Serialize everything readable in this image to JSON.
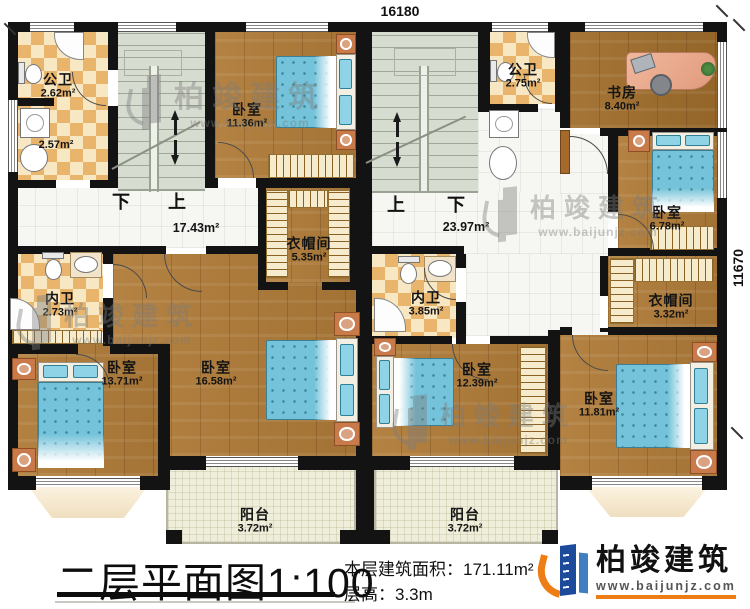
{
  "dimensions": {
    "top": "16180",
    "right": "11670"
  },
  "stairs": {
    "left_down": "下",
    "left_up": "上",
    "right_up": "上",
    "right_down": "下"
  },
  "rooms": {
    "bath_tl": {
      "name": "公卫",
      "area": "2.62m²",
      "area2": "2.57m²"
    },
    "bedroom_tl": {
      "name": "卧室",
      "area": "11.36m²"
    },
    "cloak_left": {
      "name": "衣帽间",
      "area": "5.35m²"
    },
    "hall_left": {
      "area": "17.43m²"
    },
    "bath_ml": {
      "name": "内卫",
      "area": "2.73m²"
    },
    "bedroom_bl": {
      "name": "卧室",
      "area": "13.71m²"
    },
    "bedroom_bm": {
      "name": "卧室",
      "area": "16.58m²"
    },
    "balcony_left": {
      "name": "阳台",
      "area": "3.72m²"
    },
    "bath_tr": {
      "name": "公卫",
      "area": "2.75m²"
    },
    "study": {
      "name": "书房",
      "area": "8.40m²"
    },
    "bedroom_r1": {
      "name": "卧室",
      "area": "6.78m²"
    },
    "hall_right": {
      "area": "23.97m²"
    },
    "cloak_right": {
      "name": "衣帽间",
      "area": "3.32m²"
    },
    "bath_mr": {
      "name": "内卫",
      "area": "3.85m²"
    },
    "bedroom_br1": {
      "name": "卧室",
      "area": "12.39m²"
    },
    "bedroom_br2": {
      "name": "卧室",
      "area": "11.81m²"
    },
    "balcony_right": {
      "name": "阳台",
      "area": "3.72m²"
    }
  },
  "watermark": {
    "brand": "柏竣建筑",
    "url": "www.baijunjz.com"
  },
  "footer": {
    "title": "二层平面图",
    "scale": "1:100",
    "area_label": "本层建筑面积：",
    "area_value": "171.11m²",
    "height_label": "层高：",
    "height_value": "3.3m",
    "brand": "柏竣建筑",
    "brand_url": "www.baijunjz.com"
  }
}
